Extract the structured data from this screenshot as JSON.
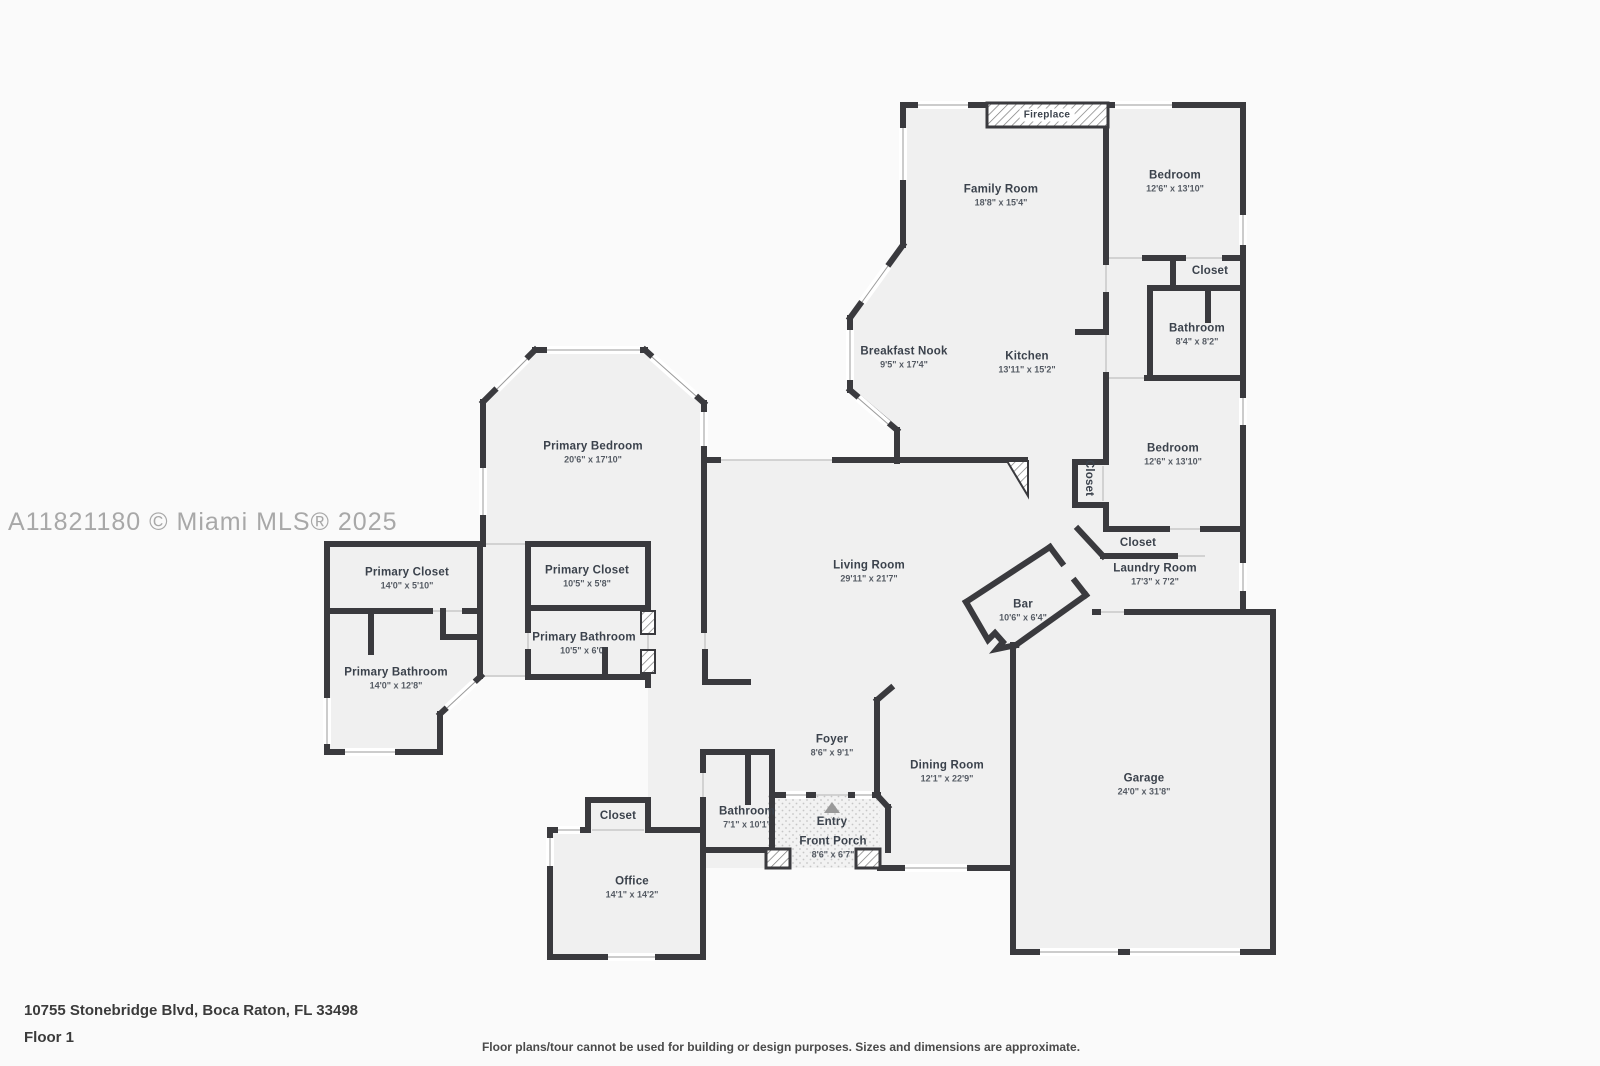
{
  "watermark": "A11821180 © Miami MLS® 2025",
  "fireplace": {
    "label": "Fireplace"
  },
  "footer": {
    "address": "10755 Stonebridge Blvd, Boca Raton, FL 33498",
    "floor": "Floor 1",
    "disclaimer": "Floor plans/tour cannot be used for building or design purposes. Sizes and dimensions are approximate."
  },
  "colors": {
    "wall": "#3a3a3e",
    "floor": "#f0f0f0",
    "label": "#3b424c",
    "watermark": "#a8a8a8",
    "entry_triangle": "#999999"
  },
  "entry_marker": "triangle-up",
  "rooms": [
    {
      "name": "Family Room",
      "dims": "18'8\" x 15'4\"",
      "x": 1001,
      "y": 196
    },
    {
      "name": "Bedroom",
      "dims": "12'6\" x 13'10\"",
      "x": 1175,
      "y": 182
    },
    {
      "name": "Closet",
      "dims": "",
      "x": 1210,
      "y": 271
    },
    {
      "name": "Bathroom",
      "dims": "8'4\" x 8'2\"",
      "x": 1197,
      "y": 335
    },
    {
      "name": "Breakfast Nook",
      "dims": "9'5\" x 17'4\"",
      "x": 904,
      "y": 358
    },
    {
      "name": "Kitchen",
      "dims": "13'11\" x 15'2\"",
      "x": 1027,
      "y": 363
    },
    {
      "name": "Bedroom",
      "dims": "12'6\" x 13'10\"",
      "x": 1173,
      "y": 455
    },
    {
      "name": "Closet",
      "dims": "",
      "x": 1089,
      "y": 478,
      "vertical": true
    },
    {
      "name": "Primary Bedroom",
      "dims": "20'6\" x 17'10\"",
      "x": 593,
      "y": 453
    },
    {
      "name": "Primary Closet",
      "dims": "14'0\" x 5'10\"",
      "x": 407,
      "y": 579
    },
    {
      "name": "Primary Closet",
      "dims": "10'5\" x 5'8\"",
      "x": 587,
      "y": 577
    },
    {
      "name": "Closet",
      "dims": "",
      "x": 1138,
      "y": 543
    },
    {
      "name": "Laundry Room",
      "dims": "17'3\" x 7'2\"",
      "x": 1155,
      "y": 575
    },
    {
      "name": "Living Room",
      "dims": "29'11\" x 21'7\"",
      "x": 869,
      "y": 572
    },
    {
      "name": "Bar",
      "dims": "10'6\" x 6'4\"",
      "x": 1023,
      "y": 611
    },
    {
      "name": "Primary Bathroom",
      "dims": "10'5\" x 6'0\"",
      "x": 584,
      "y": 644
    },
    {
      "name": "Primary Bathroom",
      "dims": "14'0\" x 12'8\"",
      "x": 396,
      "y": 679
    },
    {
      "name": "Foyer",
      "dims": "8'6\" x 9'1\"",
      "x": 832,
      "y": 746
    },
    {
      "name": "Dining Room",
      "dims": "12'1\" x 22'9\"",
      "x": 947,
      "y": 772
    },
    {
      "name": "Garage",
      "dims": "24'0\" x 31'8\"",
      "x": 1144,
      "y": 785
    },
    {
      "name": "Closet",
      "dims": "",
      "x": 618,
      "y": 816
    },
    {
      "name": "Bathroom",
      "dims": "7'1\" x 10'1\"",
      "x": 747,
      "y": 818
    },
    {
      "name": "Entry",
      "dims": "",
      "x": 832,
      "y": 822
    },
    {
      "name": "Front Porch",
      "dims": "8'6\" x 6'7\"",
      "x": 833,
      "y": 848
    },
    {
      "name": "Office",
      "dims": "14'1\" x 14'2\"",
      "x": 632,
      "y": 888
    }
  ]
}
